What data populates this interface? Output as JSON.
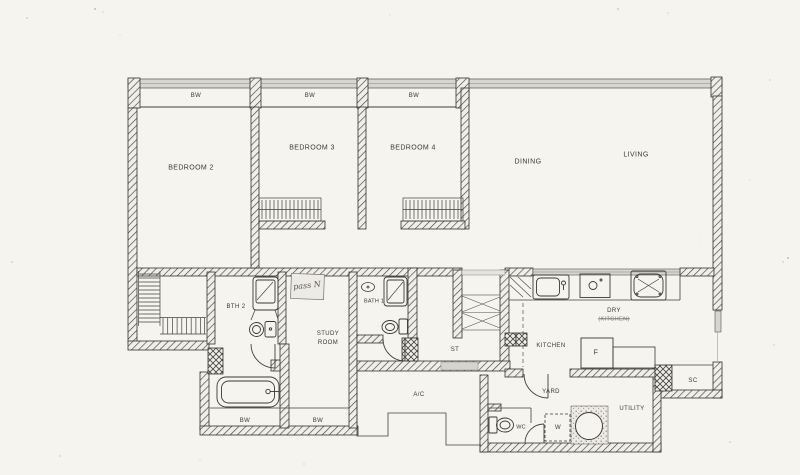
{
  "colors": {
    "paper": "#f5f4ef",
    "ink": "#3b3833",
    "wall_gray": "#d8d6d0"
  },
  "labels": {
    "bw_top_bedroom2": "BW",
    "bw_top_bedroom3": "BW",
    "bw_top_bedroom4": "BW",
    "bedroom2": "BEDROOM 2",
    "bedroom3": "BEDROOM 3",
    "bedroom4": "BEDROOM 4",
    "dining": "DINING",
    "living": "LIVING",
    "bath2": "BTH 2",
    "bath1": "BATH 1",
    "study_line1": "STUDY",
    "study_line2": "ROOM",
    "store": "ST",
    "kitchen": "KITCHEN",
    "dry": "DRY",
    "dry_sub": "(KITCHEN)",
    "fridge": "F",
    "sc": "SC",
    "yard": "YARD",
    "ac": "A/C",
    "utility": "UTILITY",
    "wc": "WC",
    "washer": "W",
    "bw_bottom_bath": "BW",
    "bw_bottom_study": "BW",
    "note": "pass N"
  }
}
